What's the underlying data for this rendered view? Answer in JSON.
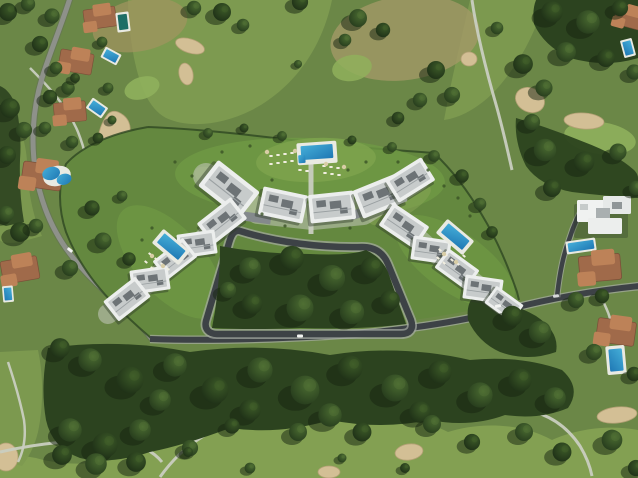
{
  "scene": {
    "type": "aerial-photograph",
    "view": "top-down drone view",
    "description": "Aerial photograph of a modern white apartment development with three communal swimming pools arranged around a loop road, set inside a golf course with fairways, sand bunkers, terracotta-roofed villas with private pools, and a dense belt of trees"
  },
  "colors": {
    "base-grass": "#6b8747",
    "fairway": "#7d9a50",
    "fairway-light": "#83a052",
    "dry-grass": "#a3945f",
    "forest": "#2c431f",
    "tree-shadow": "#16230f",
    "hedge": "#2e4722",
    "road-asphalt": "#3d4246",
    "road-light": "#8e918a",
    "curb": "#a7aca4",
    "cart-path": "#c9cdc0",
    "sand": "#d3bf95",
    "sand-edge": "#b3a075",
    "pool-water": "#45aed8",
    "pool-deep": "#1f78b4",
    "pool-dark": "#1e6e66",
    "pool-deck": "#e9eae2",
    "roof-white": "#eceeed",
    "roof-gray": "#c7cbcb",
    "roof-unit": "#6d7376",
    "building-shadow": "#2f3c28",
    "terracotta": "#a06a4a",
    "terracotta-light": "#bd8258",
    "lounger": "#f1eee0",
    "umbrella": "#d8cda6",
    "promenade": "#c4c9bd"
  },
  "development": {
    "loop_road": true,
    "clusters": [
      {
        "name": "north-terrace",
        "blocks": 5
      },
      {
        "name": "west-terrace",
        "blocks": 5
      },
      {
        "name": "east-terrace",
        "blocks": 5
      }
    ],
    "pools": [
      {
        "name": "north-pool",
        "shape": "rectangular with kids corner"
      },
      {
        "name": "west-pool",
        "shape": "rectangular, angled"
      },
      {
        "name": "east-pool",
        "shape": "rectangular, angled"
      }
    ],
    "amenities": [
      "sun loungers",
      "parasols",
      "landscaped lawns",
      "central woodland"
    ]
  },
  "surroundings": {
    "golf_course": {
      "fairways": true,
      "bunkers": 10,
      "cart_paths": 5,
      "greens": 3
    },
    "villas": {
      "west_side": 5,
      "east_side": 4,
      "style": "terracotta-roofed with private pools"
    },
    "modern_villa": {
      "position": "east",
      "style": "white flat-roof",
      "pool": true
    },
    "vegetation": "dense tree belt south of the access road and scattered mature trees"
  }
}
